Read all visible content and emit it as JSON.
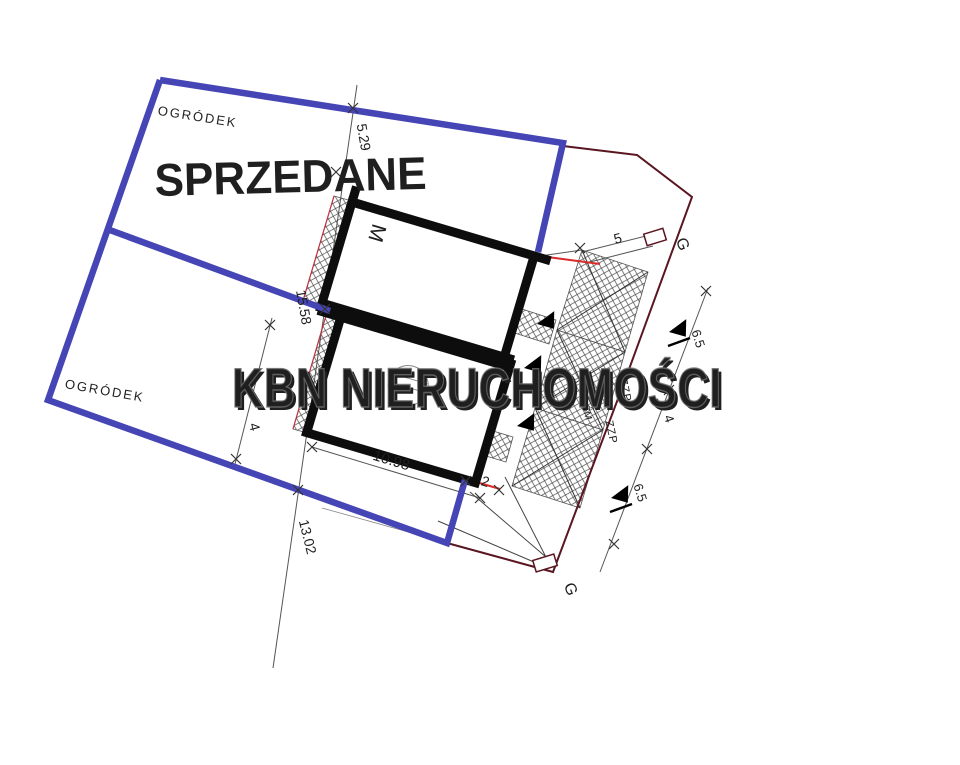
{
  "plan": {
    "watermark": "KBN NIERUCHOMOŚCI",
    "sold_label": "SPRZEDANE",
    "garden_label_top": "OGRÓDEK",
    "garden_label_bottom": "OGRÓDEK",
    "building_unit_label": "M",
    "gate_label_top": "G",
    "gate_label_bottom": "G",
    "annotations": {
      "zzp_1": "ZZP",
      "zzp_2": "ZZP",
      "sm": "ŚM"
    },
    "dimensions": {
      "top_left": "5.29",
      "side_left": "15.58",
      "garden_width": "4",
      "bottom_left": "13.02",
      "building_width": "10.98",
      "terrace_offset": "2",
      "walkway": "5",
      "right_upper": "6.5",
      "right_middle": "4",
      "right_lower": "6.5"
    },
    "colors": {
      "plot_boundary_blue": "#4545b5",
      "outer_boundary_maroon": "#5a1620",
      "accent_red": "#d92b2b",
      "sold_red": "#e5282e",
      "wall_black": "#0d0d0d"
    }
  }
}
